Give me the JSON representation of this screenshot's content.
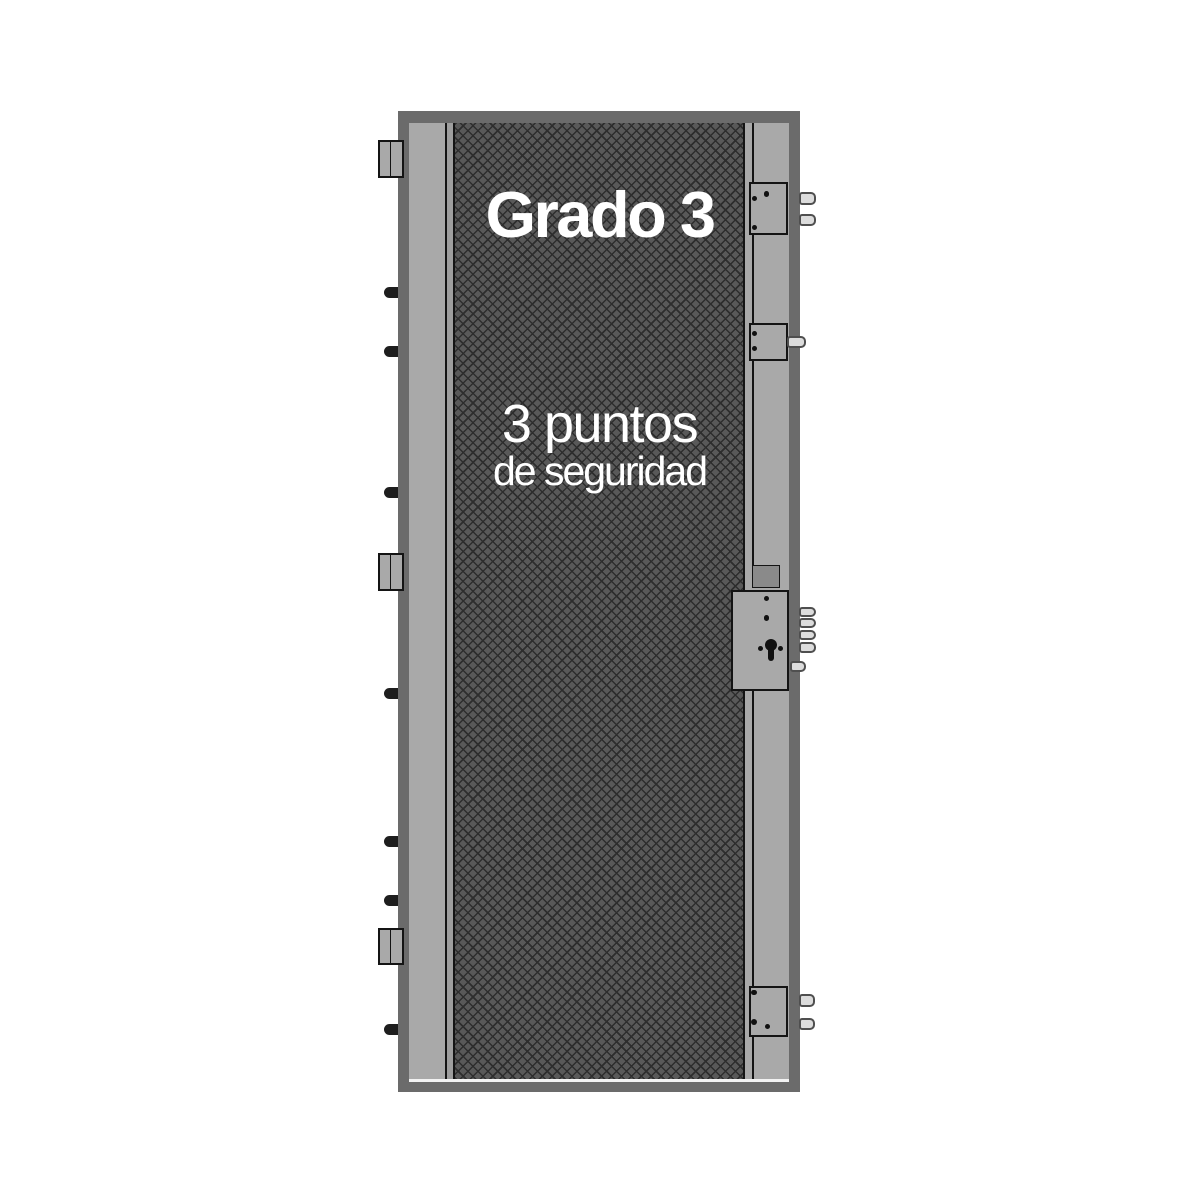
{
  "door": {
    "grade_label": "Grado 3",
    "security_line1": "3 puntos",
    "security_line2": "de seguridad",
    "locking_points_count": "3"
  },
  "colors": {
    "background": "#ffffff",
    "frame": "#6b6b6b",
    "stile": "#a9a9a9",
    "edge_strip": "#9e9e9e",
    "edge_line": "#141414",
    "core_base": "#595959",
    "core_line": "#2d2d2d",
    "lock_box": "#a9a9a9",
    "lock_box_border": "#141414",
    "dark_plate": "#8a8a8a",
    "bolt_fill": "#dcdcdc",
    "bolt_border": "#4f4f4f",
    "pin": "#1e1e1e",
    "dot": "#111111",
    "text": "#ffffff",
    "bottom_highlight": "#f2f2f2"
  },
  "hinges": [
    {
      "x": 377.5,
      "y": 139.5,
      "w": 26,
      "h": 38
    },
    {
      "x": 377.5,
      "y": 552.5,
      "w": 26,
      "h": 38.5
    },
    {
      "x": 377.5,
      "y": 927.5,
      "w": 26,
      "h": 37.5
    }
  ],
  "pins": [
    {
      "x": 384,
      "y": 286.5,
      "w": 14,
      "h": 11
    },
    {
      "x": 384,
      "y": 346,
      "w": 14,
      "h": 11
    },
    {
      "x": 384,
      "y": 487,
      "w": 14,
      "h": 11
    },
    {
      "x": 384,
      "y": 688,
      "w": 14,
      "h": 11
    },
    {
      "x": 384,
      "y": 836,
      "w": 14,
      "h": 11
    },
    {
      "x": 384,
      "y": 895,
      "w": 14,
      "h": 11
    },
    {
      "x": 384,
      "y": 1024,
      "w": 14,
      "h": 11
    }
  ],
  "lock_boxes": [
    {
      "name": "top",
      "x": 749,
      "y": 182,
      "w": 39,
      "h": 53
    },
    {
      "name": "upper-mid",
      "x": 749,
      "y": 322.5,
      "w": 39,
      "h": 38.5
    },
    {
      "name": "main",
      "x": 731,
      "y": 590,
      "w": 58,
      "h": 101
    },
    {
      "name": "bottom",
      "x": 749,
      "y": 986,
      "w": 39,
      "h": 51
    }
  ],
  "dark_plate": {
    "x": 752,
    "y": 565,
    "w": 27.5,
    "h": 23
  },
  "stile_divider_segments": [
    {
      "y": 123,
      "h": 59
    },
    {
      "y": 235,
      "h": 88
    },
    {
      "y": 361,
      "h": 204
    },
    {
      "y": 691,
      "h": 295
    },
    {
      "y": 1037,
      "h": 42
    }
  ],
  "bolts": [
    {
      "type": "deadbolt",
      "x": 799,
      "y": 192,
      "w": 17,
      "h": 13
    },
    {
      "type": "deadbolt",
      "x": 799,
      "y": 214,
      "w": 17,
      "h": 12
    },
    {
      "type": "latch",
      "x": 787,
      "y": 336,
      "w": 19,
      "h": 11.5
    },
    {
      "type": "deadbolt",
      "x": 799,
      "y": 606.5,
      "w": 17,
      "h": 10.5
    },
    {
      "type": "deadbolt",
      "x": 799,
      "y": 618.3,
      "w": 17,
      "h": 10
    },
    {
      "type": "deadbolt",
      "x": 799,
      "y": 630,
      "w": 17,
      "h": 10
    },
    {
      "type": "deadbolt",
      "x": 799,
      "y": 641.7,
      "w": 17,
      "h": 11.5
    },
    {
      "type": "latch",
      "x": 790,
      "y": 660.5,
      "w": 16,
      "h": 11.5
    },
    {
      "type": "deadbolt",
      "x": 799,
      "y": 994,
      "w": 16,
      "h": 12.5
    },
    {
      "type": "deadbolt",
      "x": 799,
      "y": 1018,
      "w": 16,
      "h": 12
    }
  ],
  "dots": [
    {
      "x": 754.7,
      "y": 198.3,
      "d": 5.5
    },
    {
      "x": 766.7,
      "y": 193.8,
      "d": 5.5
    },
    {
      "x": 754.7,
      "y": 227.3,
      "d": 5.5
    },
    {
      "x": 754.3,
      "y": 333.3,
      "d": 5
    },
    {
      "x": 754.3,
      "y": 348.3,
      "d": 5
    },
    {
      "x": 766.3,
      "y": 598.7,
      "d": 5
    },
    {
      "x": 766.7,
      "y": 618,
      "d": 5.5
    },
    {
      "x": 760.5,
      "y": 648.3,
      "d": 5.5
    },
    {
      "x": 780.5,
      "y": 648.3,
      "d": 5
    },
    {
      "x": 754,
      "y": 992.3,
      "d": 5.5
    },
    {
      "x": 754,
      "y": 1021.7,
      "d": 6
    },
    {
      "x": 767.3,
      "y": 1026,
      "d": 5
    }
  ],
  "keyhole": {
    "cx": 771,
    "cy": 645,
    "head_d": 12,
    "tail_w": 6,
    "tail_h": 16
  }
}
